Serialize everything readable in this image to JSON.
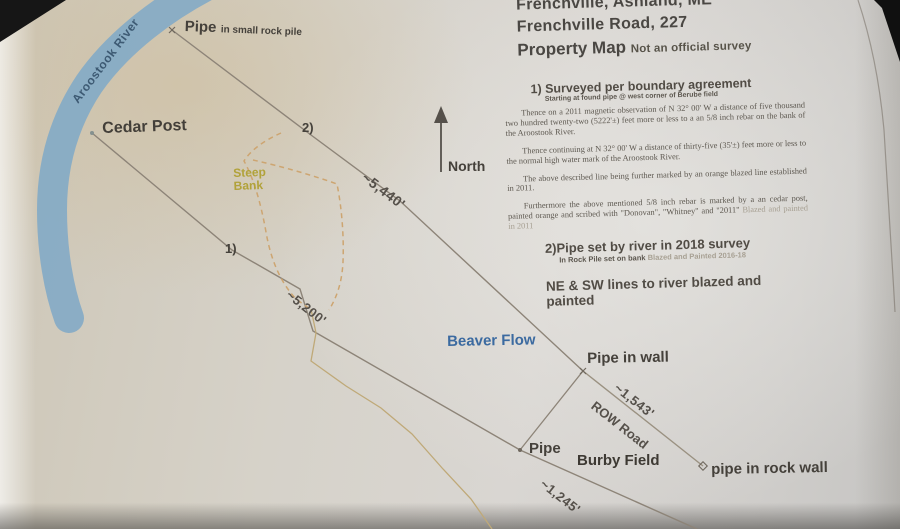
{
  "header": {
    "line1": "Frenchville, Ashland, ME",
    "line2": "Frenchville Road, 227",
    "title": "Property Map",
    "subtitle": "Not an official survey"
  },
  "notes": {
    "note1": {
      "heading": "1) Surveyed per boundary agreement",
      "subheading": "Starting at found pipe @ west corner of Berube field",
      "para1": "Thence on a 2011 magnetic observation of N 32° 00' W a distance of five thousand two hundred twenty-two (5222'±) feet more or less to a an 5/8 inch rebar on the bank of the Aroostook River.",
      "para2": "Thence continuing at N 32° 00' W a distance of thirty-five (35'±) feet more or less to the normal high water mark of the Aroostook River.",
      "para3": "The above described line being further marked by an orange blazed line established in 2011.",
      "para4": "Furthermore the above mentioned 5/8 inch rebar is marked by a an cedar post, painted orange and scribed with \"Donovan\", \"Whitney\" and \"2011\"",
      "para4_faint": "Blazed and painted in 2011"
    },
    "note2": {
      "heading": "2)Pipe set by river in 2018 survey",
      "subheading": "In Rock Pile set on bank",
      "subheading_faint": "Blazed and Painted 2016-18"
    },
    "note3": "NE & SW lines to river blazed and painted"
  },
  "map": {
    "river_label": "Aroostook River",
    "labels": {
      "pipe_top": "Pipe",
      "pipe_top_detail": "in small rock pile",
      "cedar_post": "Cedar Post",
      "steep_bank_line1": "Steep",
      "steep_bank_line2": "Bank",
      "marker2": "2)",
      "marker1": "1)",
      "north": "North",
      "dist_5440": "~5,440'",
      "dist_5200": "~5,200'",
      "beaver_flow": "Beaver Flow",
      "pipe_in_wall": "Pipe in wall",
      "dist_1543": "~1,543'",
      "row_road": "ROW Road",
      "pipe": "Pipe",
      "burby_field": "Burby Field",
      "pipe_in_rock_wall": "pipe in rock wall",
      "dist_1245": "~1,245'"
    },
    "colors": {
      "river": "#84aac5",
      "boundary_line": "#8d8478",
      "bank_dash": "#cda571",
      "steep_bank_text": "#b1a23a",
      "water_text": "#3b6aa0",
      "ink": "#45413b"
    }
  }
}
